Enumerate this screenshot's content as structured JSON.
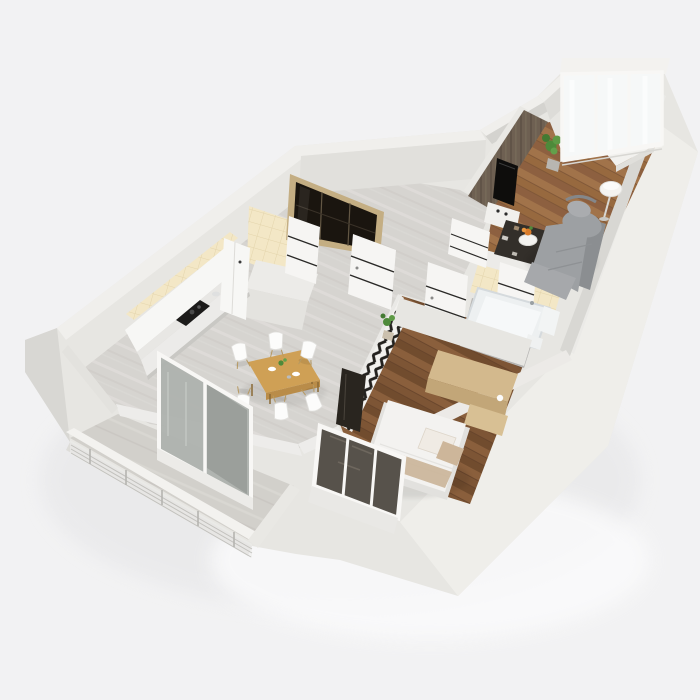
{
  "meta": {
    "description": "3D isometric render of a one-bedroom apartment floor plan, viewed from above at an angle",
    "view": "bird's-eye axonometric, no text labels"
  },
  "colors": {
    "background": "#f2f2f3",
    "building_face": "#e7e6e2",
    "building_face_bright": "#efeeea",
    "building_face_shade": "#d8d7d3",
    "wall_top": "#f0efec",
    "wall_inner": "#e1e0dc",
    "tile_floor": "#d6d4d0",
    "wood_living": "#97693f",
    "wood_bedroom": "#7d5535",
    "concrete": "#d2d0cb",
    "cream_tile": "#f3e7c6",
    "bath_tile": "#b8b7b5",
    "accent_wall": "#6e6052",
    "chevron_dark": "#23211e",
    "chevron_light": "#f2f1ee",
    "door_white": "#f6f5f3",
    "door_stripe": "#2a2927",
    "frame_white": "#f8f7f5",
    "glass_bright": "#f6f8f8",
    "glass_door": "#aeb2ae",
    "sofa_gray": "#9da0a3",
    "sofa_gray_dark": "#8b8e91",
    "bed_white": "#f3f2f0",
    "pillow_beige": "#cdb69a",
    "table_wood": "#cfa055",
    "sideboard_wood": "#d3b98d",
    "wardrobe_glass": "#1a150f",
    "wardrobe_frame": "#c4ae83",
    "plant_green": "#4e8a3a",
    "rug_dark": "#332f2a",
    "lamp_white": "#f4f3f0",
    "tv_black": "#0e0d0c",
    "tub_white": "#edf0f1",
    "cabinet_white": "#f7f7f5",
    "counter_dark": "#1c1b1a",
    "threshold": "#ecebe8"
  },
  "rooms": [
    {
      "id": "kitchen-dining",
      "floor": "light-marble-tile",
      "furniture": [
        "tall-cabinets",
        "counter",
        "cooktop",
        "fridge",
        "dining-table",
        "dining-chairs"
      ]
    },
    {
      "id": "entry-hall",
      "floor": "light-marble-tile",
      "furniture": [
        "sliding-wardrobe",
        "interior-doors",
        "floor-plant"
      ]
    },
    {
      "id": "living-room",
      "floor": "wood-plank",
      "furniture": [
        "sofa",
        "armchair",
        "floor-lamp",
        "patterned-rug",
        "coffee-table",
        "tv-accent-wall",
        "media-console",
        "plant",
        "console-table",
        "glazed-wall"
      ]
    },
    {
      "id": "bathroom",
      "floor": "gray-tile",
      "furniture": [
        "bathtub",
        "toilet",
        "washbasin",
        "cream-tile-wall"
      ]
    },
    {
      "id": "bedroom",
      "floor": "wood-plank-dark",
      "furniture": [
        "double-bed",
        "wood-sideboard",
        "tv-panel",
        "chevron-accent-wall",
        "corner-window"
      ]
    },
    {
      "id": "balcony-south",
      "floor": "concrete",
      "furniture": [
        "cable-railing",
        "glazed-sliding-door"
      ]
    },
    {
      "id": "balcony-north",
      "floor": "wood",
      "furniture": [
        "glazed-window-wall"
      ]
    }
  ],
  "counts": {
    "dining_chairs": 6,
    "interior_doors": 5,
    "window_panes": 3,
    "railing_posts": 5
  }
}
